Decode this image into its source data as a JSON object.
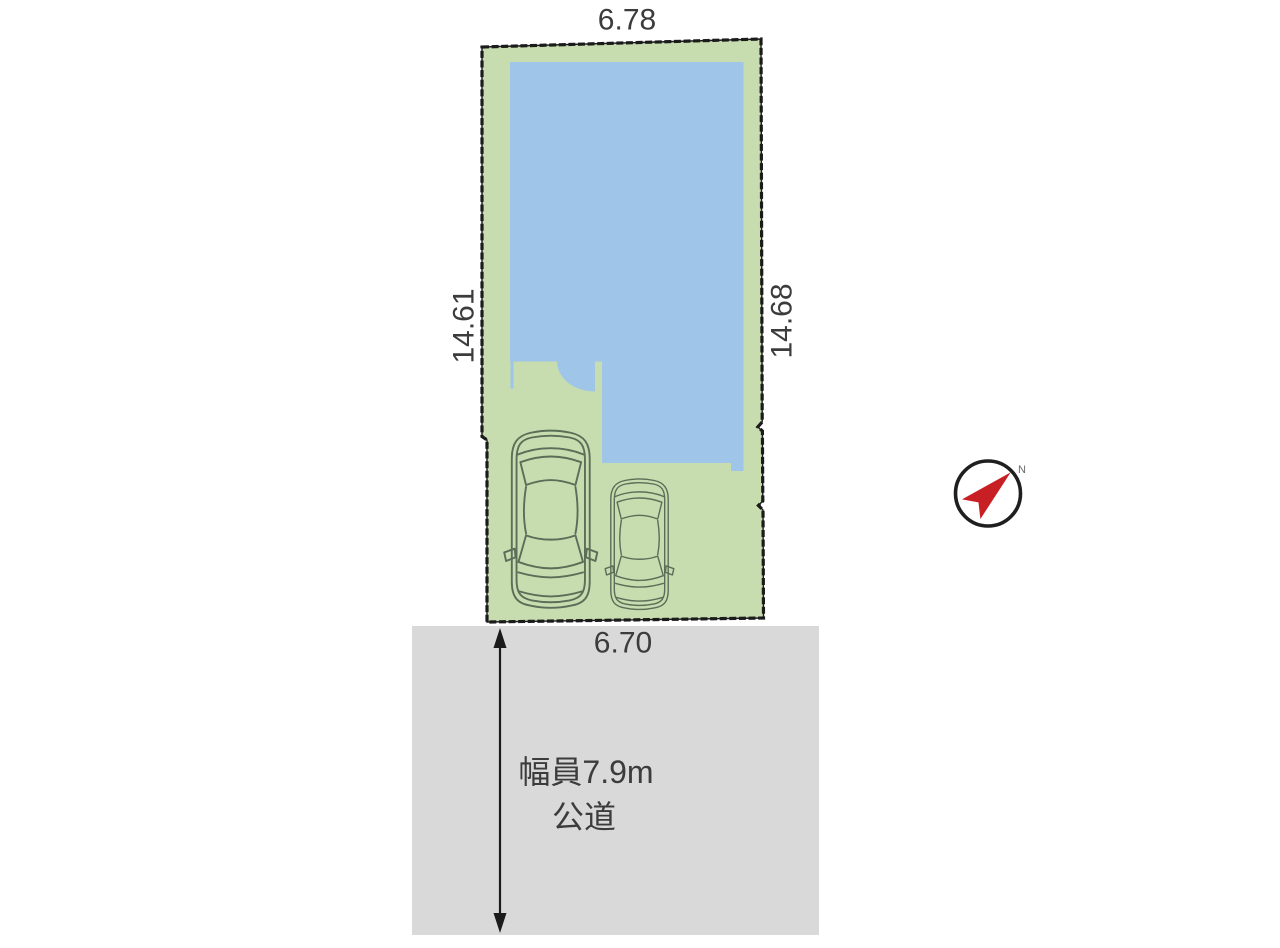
{
  "diagram": {
    "dimensions": {
      "top_width": "6.78",
      "left_depth": "14.61",
      "right_depth": "14.68",
      "frontage": "6.70"
    },
    "road": {
      "width_label": "幅員7.9m",
      "type_label": "公道"
    },
    "compass": {
      "north_label": "N"
    },
    "colors": {
      "plot_fill": "#c7ddaf",
      "building_fill": "#9fc5e8",
      "road_fill": "#d9d9d9",
      "boundary": "#1b1b1b",
      "car_outline": "#5a6e58",
      "compass_arrow": "#c81f24",
      "text": "#3c3c3c"
    }
  }
}
